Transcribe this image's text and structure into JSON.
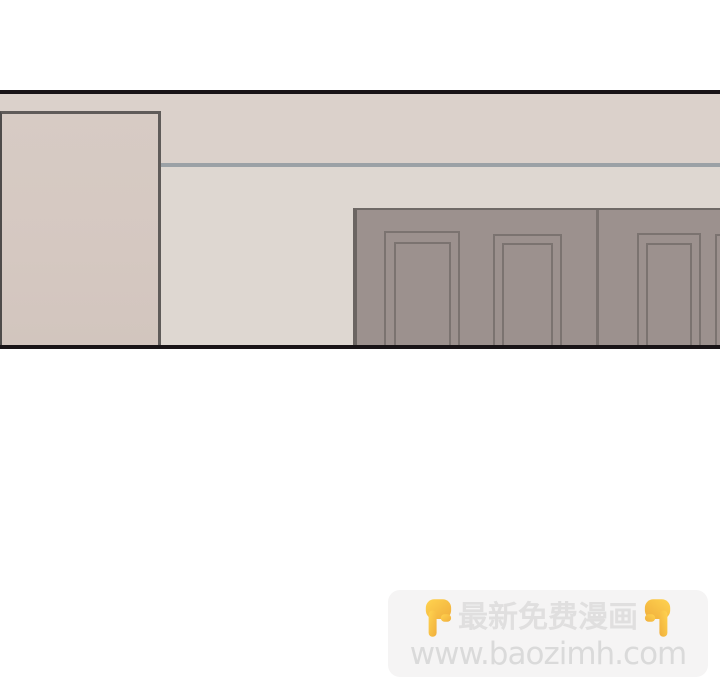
{
  "comic_panel": {
    "description": "interior scene: beige wall with tan column at left and gray paneled wardrobe doors at right",
    "colors": {
      "panel_outline": "#191417",
      "wall_upper": "#dbd1cb",
      "wall_lower": "#ded7d1",
      "trim_line": "#9ba1a6",
      "column_fill": "#d5c8c1",
      "column_border": "#5f5b59",
      "wardrobe_fill": "#9c918e",
      "wardrobe_line": "#7b7370"
    }
  },
  "watermark": {
    "badge_bg": "#f5f4f4",
    "title": "最新免费漫画",
    "url": "www.baozimh.com",
    "title_color": "#e0dfdf",
    "url_color": "#dadada",
    "emoji": "point-down",
    "emoji_yellow": "#FFD34F",
    "emoji_amber": "#F0AE3C"
  }
}
